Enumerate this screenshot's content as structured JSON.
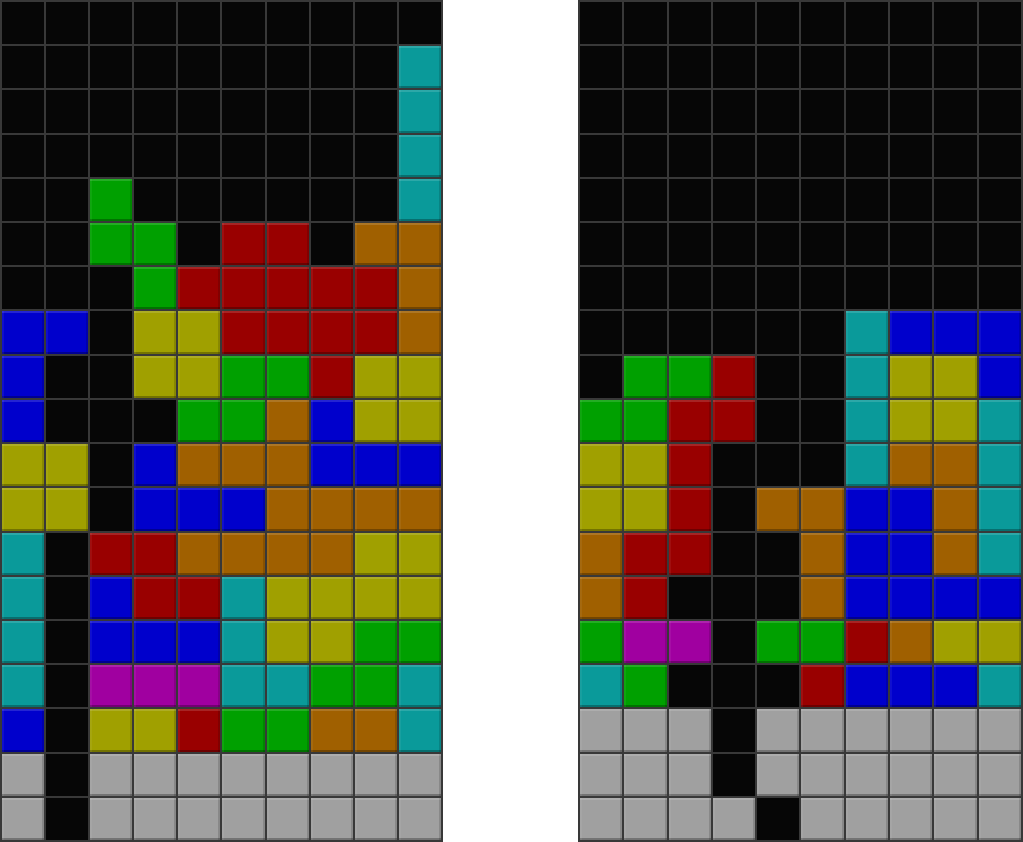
{
  "scene": {
    "background_color": "#ffffff",
    "grid_line_color": "#383838",
    "board_cols": 10,
    "board_rows": 19
  },
  "palette": {
    ".": "#060606",
    "T": "#0a9a9a",
    "B": "#0000cc",
    "G": "#00a000",
    "R": "#990000",
    "O": "#a06000",
    "Y": "#a0a000",
    "M": "#a000a0",
    "S": "#a0a0a0"
  },
  "palette_names": {
    ".": "empty-black",
    "T": "teal",
    "B": "blue",
    "G": "green",
    "R": "red",
    "O": "orange",
    "Y": "olive-yellow",
    "M": "magenta",
    "S": "garbage-gray"
  },
  "boards": [
    {
      "id": "left-board",
      "cells": [
        "..........",
        ".........T",
        ".........T",
        ".........T",
        "..G......T",
        "..GG.RR.OO",
        "...GRRRRRO",
        "BB.YYRRRRO",
        "B..YYGGRYY",
        "B...GGOBYY",
        "YY.BOOOBBB",
        "YY.BBBOOOO",
        "T.RROOOOYY",
        "T.BRRTYYYY",
        "T.BBBTYYGG",
        "T.MMMTTGGT",
        "B.YYRGGOOT",
        "S.SSSSSSSS",
        "S.SSSSSSSS"
      ]
    },
    {
      "id": "right-board",
      "cells": [
        "..........",
        "..........",
        "..........",
        "..........",
        "..........",
        "..........",
        "..........",
        "......TBBB",
        ".GGR..TYYB",
        "GGRR..TYYT",
        "YYR...TOOT",
        "YYR.OOBBOT",
        "ORR..OBBOT",
        "OR...OBBBB",
        "GMM.GGROYY",
        "TG...RBBBT",
        "SSS.SSSSSS",
        "SSS.SSSSSS",
        "SSSS.SSSSS"
      ]
    }
  ]
}
